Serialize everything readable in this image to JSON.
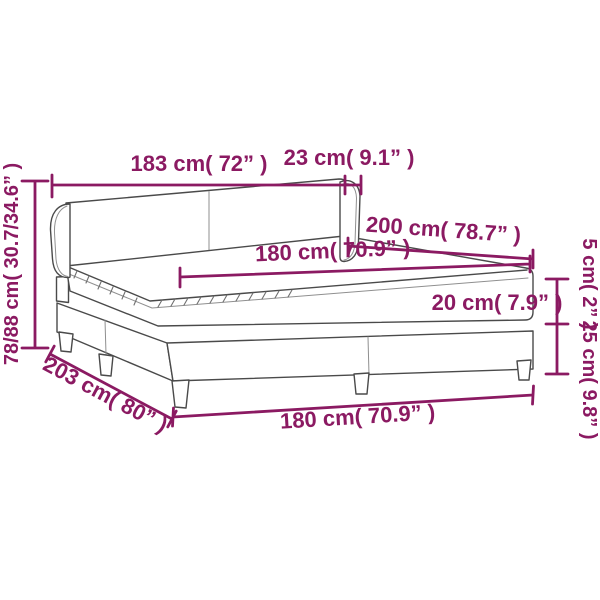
{
  "diagram": {
    "type": "product-dimension-diagram",
    "subject": "box spring bed with rolled headboard",
    "accent_color": "#8b1a62",
    "line_color": "#4a4a4a",
    "background_color": "#ffffff",
    "dimensions": {
      "headboard_width": "183 cm( 72” )",
      "headboard_wing_depth": "23 cm( 9.1” )",
      "bed_length": "200 cm( 78.7” )",
      "mattress_width": "180 cm( 70.9” )",
      "mattress_height": "20 cm( 7.9” )",
      "topper_height": "5 cm( 2” )",
      "base_height": "25 cm( 9.8” )",
      "headboard_height": "78/88 cm( 30.7/34.6” )",
      "total_length": "203 cm( 80” )",
      "bed_width": "180 cm( 70.9” )"
    }
  }
}
